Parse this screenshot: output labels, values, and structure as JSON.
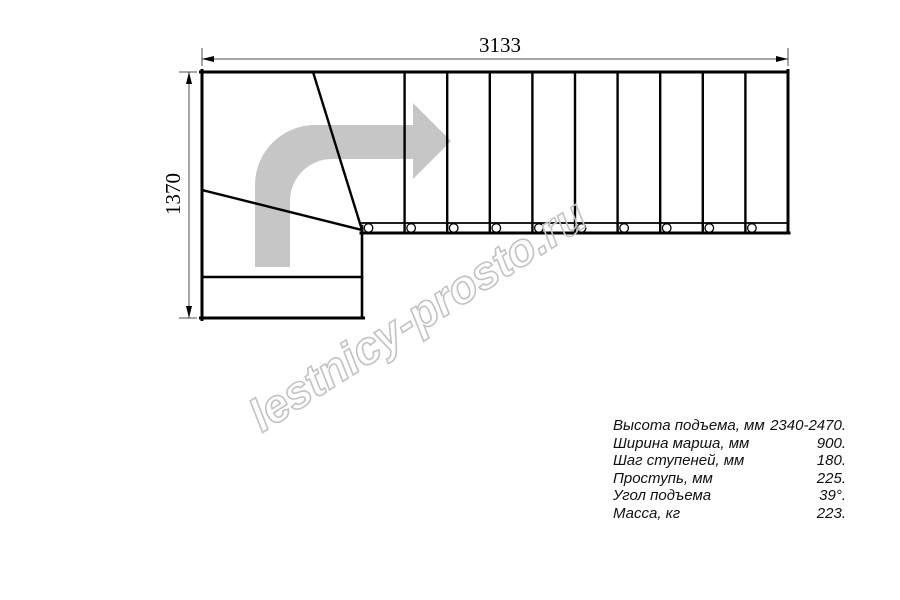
{
  "drawing": {
    "dim_width": "3133",
    "dim_height": "1370",
    "watermark": "lestnicy-prosto.ru",
    "straight_steps": 10,
    "baluster_marks": 10,
    "winder_steps": 3
  },
  "specs": {
    "rows": [
      {
        "label": "Высота подъема, мм",
        "value": "2340-2470."
      },
      {
        "label": "Ширина марша, мм",
        "value": "900."
      },
      {
        "label": "Шаг ступеней, мм",
        "value": "180."
      },
      {
        "label": "Проступь, мм",
        "value": "225."
      },
      {
        "label": "Угол подъема",
        "value": "39°."
      },
      {
        "label": "Масса, кг",
        "value": "223."
      }
    ]
  },
  "colors": {
    "line": "#000000",
    "dim": "#4d4d4d",
    "arrow": "#c6c6c6",
    "wm": "#c2c2c2",
    "spec": "#101010"
  }
}
